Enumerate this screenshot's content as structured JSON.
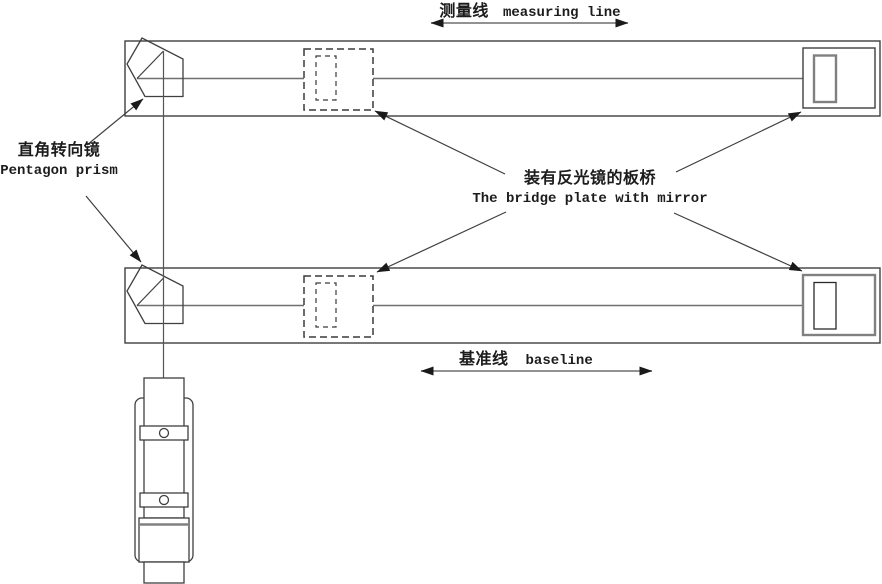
{
  "labels": {
    "measuring_line": {
      "zh": "测量线",
      "en": "measuring line"
    },
    "pentagon_prism": {
      "zh": "直角转向镜",
      "en": "Pentagon prism"
    },
    "bridge_plate": {
      "zh": "装有反光镜的板桥",
      "en": "The bridge plate with mirror"
    },
    "baseline": {
      "zh": "基准线",
      "en": "baseline"
    }
  },
  "colors": {
    "background": "#ffffff",
    "ink": "#3f3f3f",
    "soft_gray": "#6f6f6f",
    "accent_gray": "#808080",
    "text": "#1c1c1c"
  }
}
